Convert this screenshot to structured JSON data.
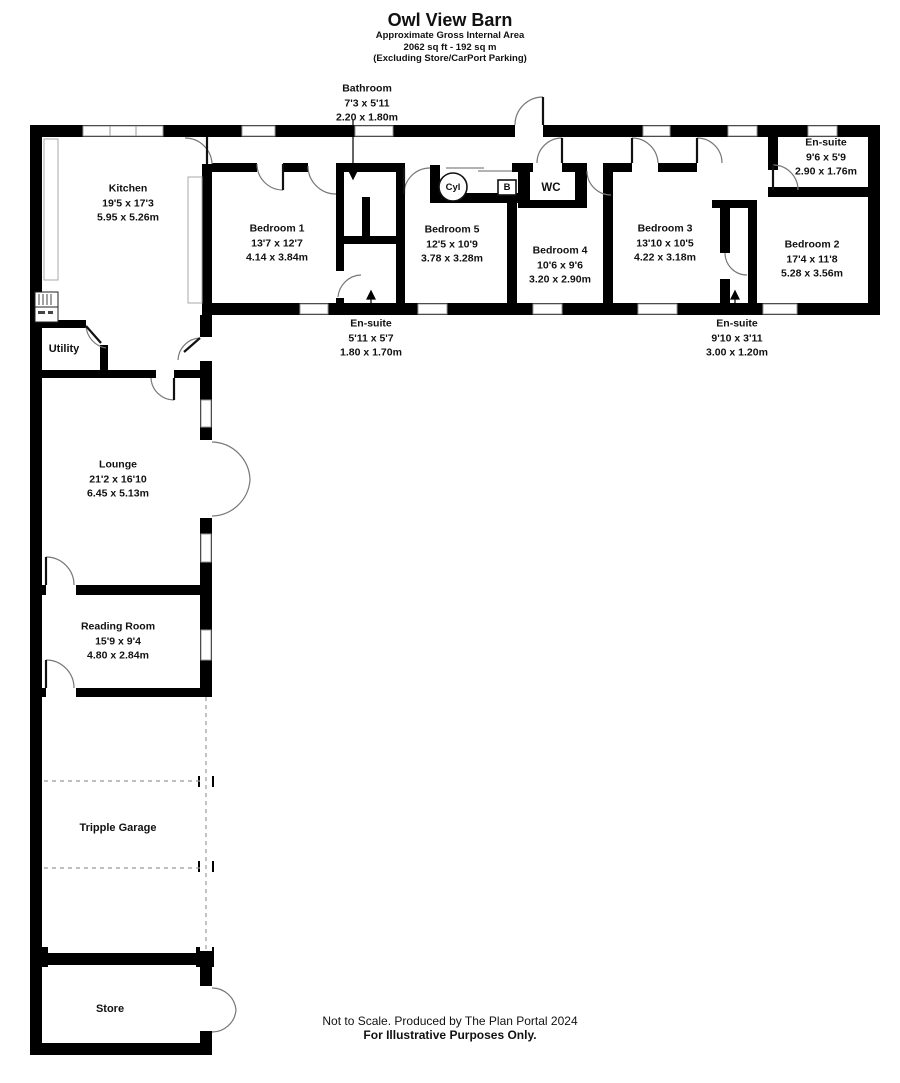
{
  "title": {
    "name": "Owl View Barn",
    "subtitle": "Approximate Gross Internal Area",
    "area": "2062 sq ft - 192 sq m",
    "note": "(Excluding Store/CarPort Parking)"
  },
  "rooms": {
    "kitchen": {
      "name": "Kitchen",
      "imperial": "19'5 x 17'3",
      "metric": "5.95 x 5.26m"
    },
    "bathroom": {
      "name": "Bathroom",
      "imperial": "7'3 x 5'11",
      "metric": "2.20 x 1.80m"
    },
    "bedroom1": {
      "name": "Bedroom 1",
      "imperial": "13'7 x 12'7",
      "metric": "4.14 x 3.84m"
    },
    "bedroom5": {
      "name": "Bedroom 5",
      "imperial": "12'5 x 10'9",
      "metric": "3.78 x 3.28m"
    },
    "bedroom4": {
      "name": "Bedroom 4",
      "imperial": "10'6 x 9'6",
      "metric": "3.20 x 2.90m"
    },
    "bedroom3": {
      "name": "Bedroom 3",
      "imperial": "13'10 x 10'5",
      "metric": "4.22 x 3.18m"
    },
    "bedroom2": {
      "name": "Bedroom 2",
      "imperial": "17'4 x 11'8",
      "metric": "5.28 x 3.56m"
    },
    "ensuite_top": {
      "name": "En-suite",
      "imperial": "9'6 x 5'9",
      "metric": "2.90 x 1.76m"
    },
    "ensuite_left": {
      "name": "En-suite",
      "imperial": "5'11 x 5'7",
      "metric": "1.80 x 1.70m"
    },
    "ensuite_right": {
      "name": "En-suite",
      "imperial": "9'10 x 3'11",
      "metric": "3.00 x 1.20m"
    },
    "wc": {
      "name": "WC"
    },
    "cyl": {
      "name": "Cyl"
    },
    "boiler": {
      "name": "B"
    },
    "utility": {
      "name": "Utility"
    },
    "lounge": {
      "name": "Lounge",
      "imperial": "21'2 x 16'10",
      "metric": "6.45 x 5.13m"
    },
    "reading_room": {
      "name": "Reading Room",
      "imperial": "15'9 x 9'4",
      "metric": "4.80 x 2.84m"
    },
    "garage": {
      "name": "Tripple Garage"
    },
    "store": {
      "name": "Store"
    }
  },
  "footer": {
    "line1": "Not to Scale. Produced by The Plan Portal 2024",
    "line2": "For Illustrative Purposes Only."
  },
  "colors": {
    "wall": "#000000",
    "background": "#ffffff",
    "window_outline": "#999999",
    "door_arc": "#777777",
    "garage_dash": "#999999"
  }
}
